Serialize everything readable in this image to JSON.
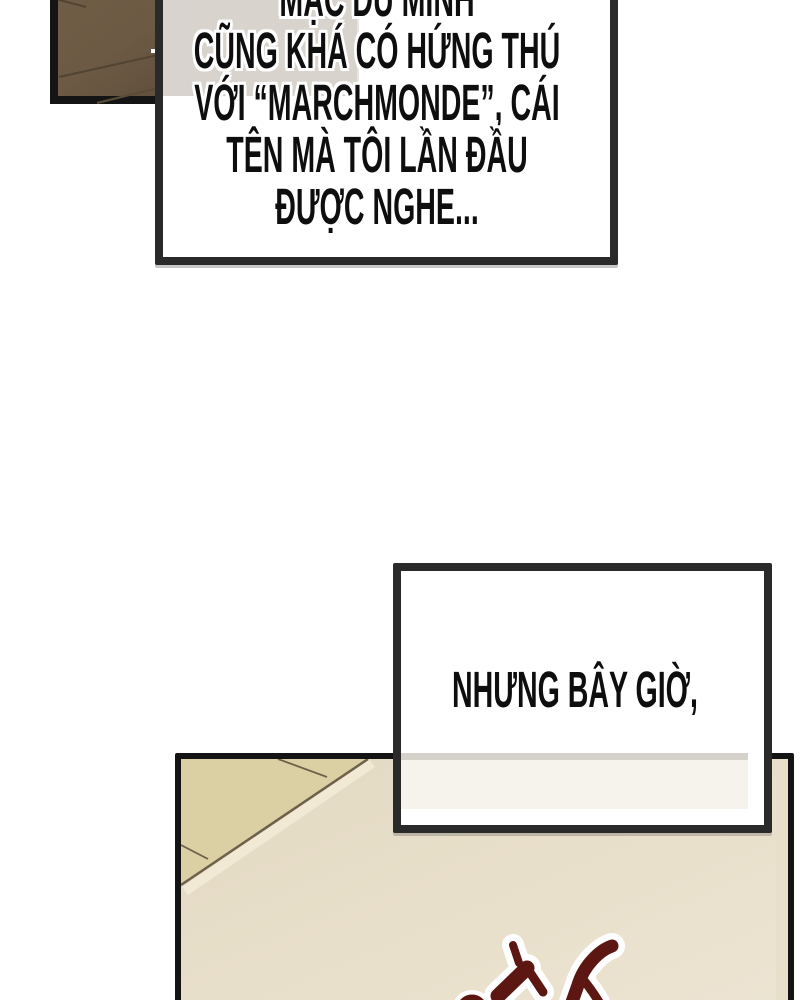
{
  "comic": {
    "caption1": {
      "lines": [
        "MẶC DÙ MÌNH",
        "CŨNG KHÁ CÓ HỨNG THÚ",
        "VỚI “MARCHMONDE”, CÁI",
        "TÊN MÀ TÔI LẦN ĐẦU",
        "ĐƯỢC NGHE..."
      ]
    },
    "caption2": {
      "text": "NHƯNG BÂY GIỜ,"
    },
    "sfx": {
      "name": "red-sound-effect-doodle",
      "color": "#5c1712",
      "outline_color": "#ffffff"
    },
    "colors": {
      "page_background": "#ffffff",
      "caption_border": "#2a2a2a",
      "panel_border": "#141414",
      "wardrobe_brown": "#6c5a44",
      "wood_grain": "#514433",
      "wall_gray": "#d8d4cd",
      "floor_yellow": "#dbcfa4",
      "floor_edge": "#6f6149",
      "room_cream": "#e8dfca",
      "text_color": "#0e0e0e"
    }
  }
}
